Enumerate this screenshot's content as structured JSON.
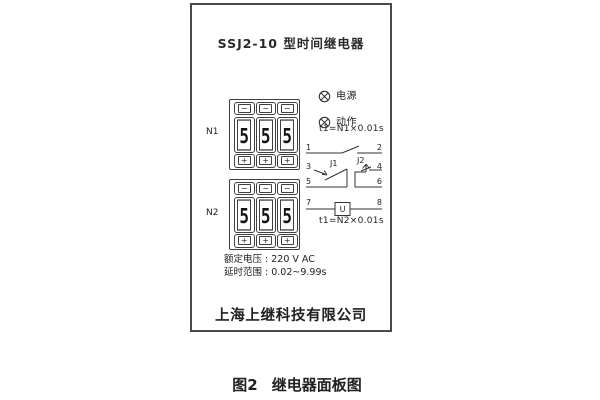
{
  "figure": {
    "caption_prefix": "图2",
    "caption_text": "继电器面板图"
  },
  "panel": {
    "title": "SSJ2-10 型时间继电器",
    "company": "上海上继科技有限公司",
    "indicators": [
      {
        "icon": "lamp",
        "label": "电源"
      },
      {
        "icon": "lamp",
        "label": "动作"
      }
    ],
    "wheel_buttons": {
      "minus": "−",
      "plus": "+"
    },
    "thumbwheels": [
      {
        "name": "N1",
        "digits": [
          "5",
          "5",
          "5"
        ],
        "formula": "t1=N1×0.01s"
      },
      {
        "name": "N2",
        "digits": [
          "5",
          "5",
          "5"
        ],
        "formula": "t1=N2×0.01s"
      }
    ],
    "schematic": {
      "terminals": [
        "1",
        "2",
        "3",
        "4",
        "5",
        "6",
        "7",
        "8"
      ],
      "contact_labels": [
        "J1",
        "J2"
      ],
      "coil_label": "U"
    },
    "specs": [
      "额定电压 : 220 V AC",
      "延时范围 : 0.02~9.99s"
    ]
  }
}
